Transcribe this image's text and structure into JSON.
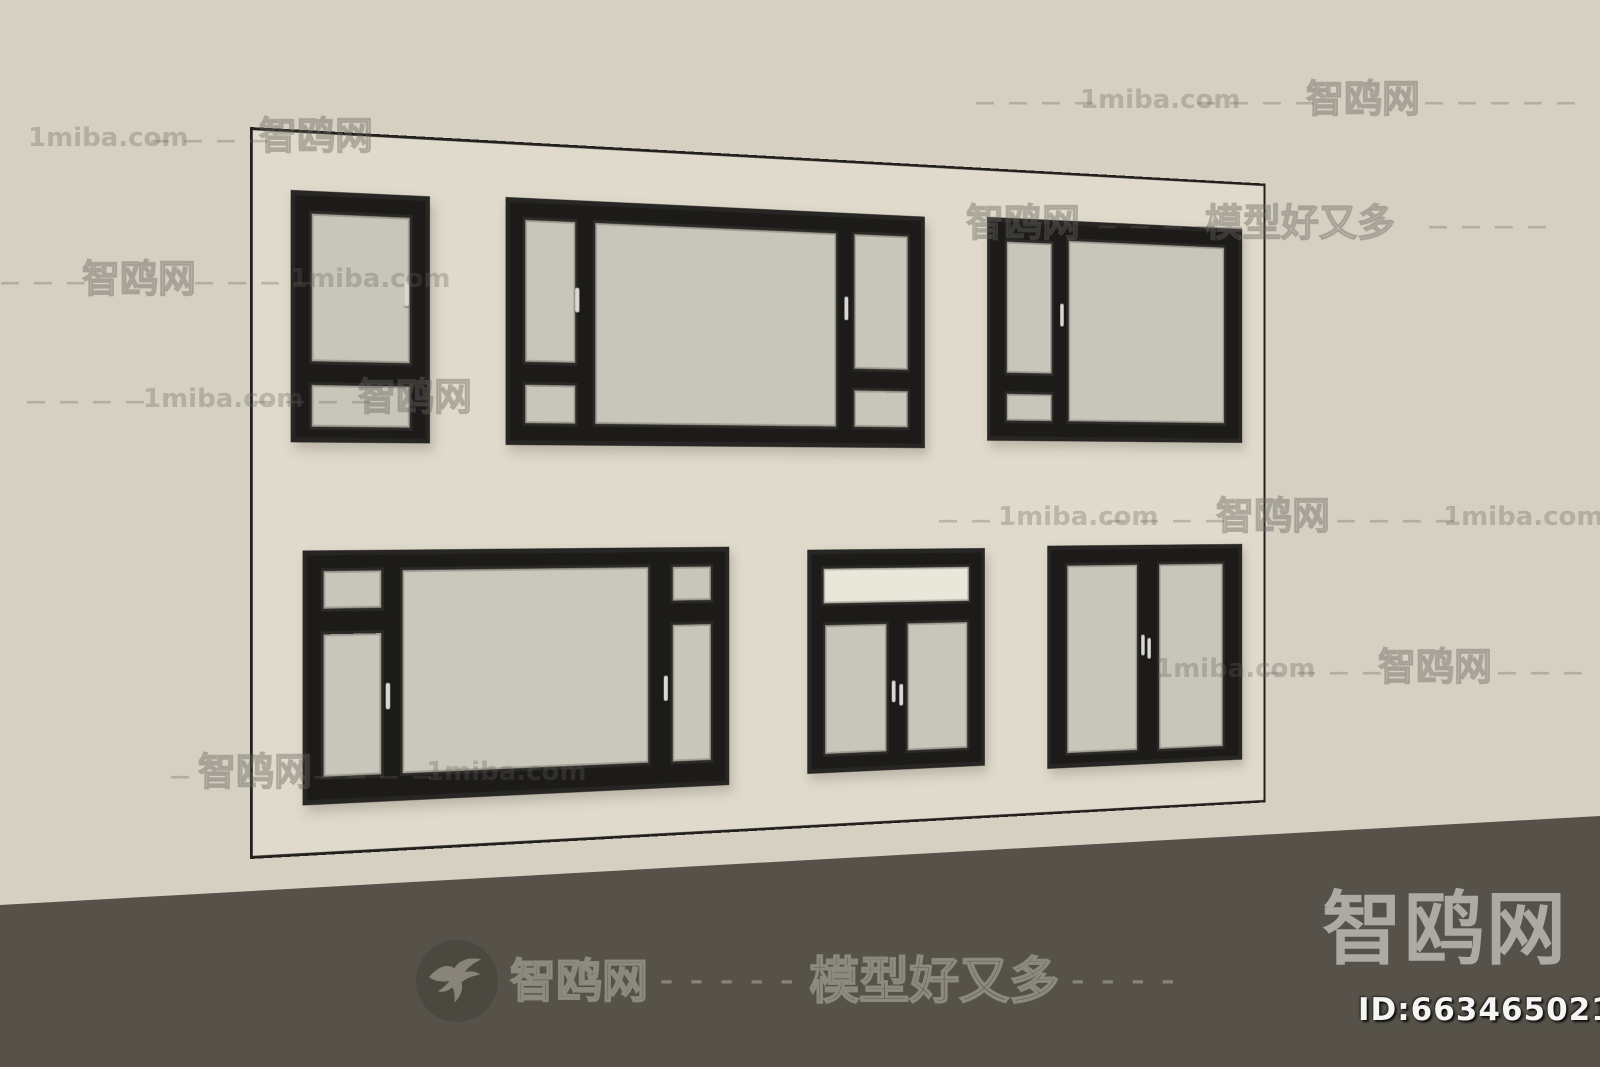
{
  "watermarks": {
    "rows": [
      {
        "segments": [
          {
            "k": "d",
            "t": "— — — —",
            "x": 975,
            "y": 92
          },
          {
            "k": "l",
            "t": "1miba.com",
            "x": 1080,
            "y": 87
          },
          {
            "k": "d",
            "t": "— — — —",
            "x": 1196,
            "y": 92
          },
          {
            "k": "c",
            "t": "智鸥网",
            "x": 1306,
            "y": 80
          },
          {
            "k": "d",
            "t": "— — — — —",
            "x": 1424,
            "y": 92
          }
        ]
      },
      {
        "segments": [
          {
            "k": "l",
            "t": "1miba.com",
            "x": 28,
            "y": 125
          },
          {
            "k": "d",
            "t": "— — — —",
            "x": 150,
            "y": 130
          },
          {
            "k": "c",
            "t": "智鸥网",
            "x": 259,
            "y": 117
          }
        ]
      },
      {
        "segments": [
          {
            "k": "c",
            "t": "智鸥网",
            "x": 966,
            "y": 204
          },
          {
            "k": "d",
            "t": "— — — —",
            "x": 1097,
            "y": 216
          },
          {
            "k": "c",
            "t": "模型好又多",
            "x": 1205,
            "y": 204
          },
          {
            "k": "d",
            "t": "— — — —",
            "x": 1428,
            "y": 216
          }
        ]
      },
      {
        "segments": [
          {
            "k": "d",
            "t": "— — —",
            "x": 0,
            "y": 272
          },
          {
            "k": "c",
            "t": "智鸥网",
            "x": 82,
            "y": 260
          },
          {
            "k": "d",
            "t": "— — — —",
            "x": 194,
            "y": 272
          },
          {
            "k": "l",
            "t": "1miba.com",
            "x": 290,
            "y": 266
          }
        ]
      },
      {
        "segments": [
          {
            "k": "d",
            "t": "— — — —",
            "x": 26,
            "y": 391
          },
          {
            "k": "l",
            "t": "1miba.com",
            "x": 143,
            "y": 386
          },
          {
            "k": "d",
            "t": "— — — —",
            "x": 252,
            "y": 391
          },
          {
            "k": "c",
            "t": "智鸥网",
            "x": 358,
            "y": 378
          }
        ]
      },
      {
        "segments": [
          {
            "k": "d",
            "t": "— —",
            "x": 938,
            "y": 510
          },
          {
            "k": "l",
            "t": "1miba.com",
            "x": 998,
            "y": 504
          },
          {
            "k": "d",
            "t": "— — — —",
            "x": 1106,
            "y": 510
          },
          {
            "k": "c",
            "t": "智鸥网",
            "x": 1216,
            "y": 497
          },
          {
            "k": "d",
            "t": "— — — —",
            "x": 1336,
            "y": 510
          },
          {
            "k": "l",
            "t": "1miba.com",
            "x": 1443,
            "y": 504
          }
        ]
      },
      {
        "segments": [
          {
            "k": "l",
            "t": "1miba.com",
            "x": 1155,
            "y": 656
          },
          {
            "k": "d",
            "t": "— — — —",
            "x": 1263,
            "y": 662
          },
          {
            "k": "c",
            "t": "智鸥网",
            "x": 1378,
            "y": 648
          },
          {
            "k": "d",
            "t": "— — —",
            "x": 1497,
            "y": 662
          }
        ]
      },
      {
        "segments": [
          {
            "k": "d",
            "t": "—",
            "x": 170,
            "y": 766
          },
          {
            "k": "c",
            "t": "智鸥网",
            "x": 198,
            "y": 753
          },
          {
            "k": "d",
            "t": "— — — —",
            "x": 313,
            "y": 766
          },
          {
            "k": "l",
            "t": "1miba.com",
            "x": 426,
            "y": 759
          }
        ]
      }
    ]
  },
  "floor_stamp": {
    "brand": "智鸥网",
    "dashes_a": "– – – – –",
    "slogan": "模型好又多",
    "dashes_b": "– – – –"
  },
  "corner": {
    "brand": "智鸥网",
    "model_id": "ID:663465021"
  }
}
